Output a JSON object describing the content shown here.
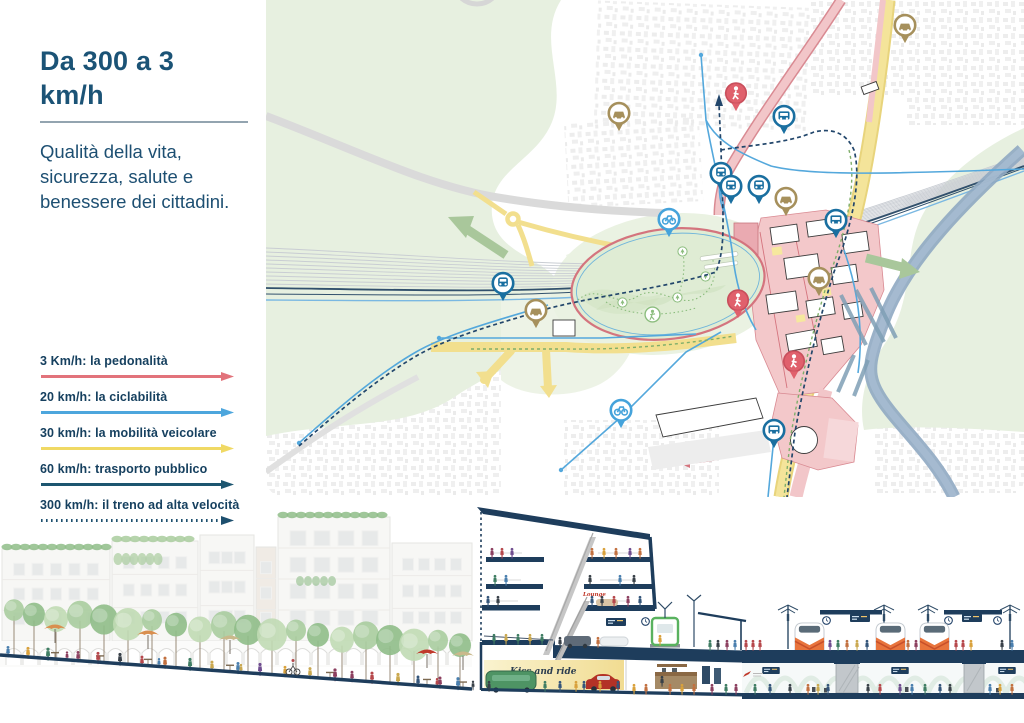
{
  "header": {
    "title_line1": "Da 300 a 3",
    "title_line2": "km/h",
    "subtitle_lines": [
      "Qualità della vita,",
      "sicurezza, salute e",
      "benessere dei cittadini."
    ]
  },
  "legend": {
    "items": [
      {
        "label": "3 Km/h: la pedonalità",
        "color": "#e2737b",
        "style": "solid"
      },
      {
        "label": "20 km/h: la ciclabilità",
        "color": "#4da6dd",
        "style": "solid"
      },
      {
        "label": "30 km/h: la mobilità veicolare",
        "color": "#f0d964",
        "style": "solid"
      },
      {
        "label": "60 km/h: trasporto pubblico",
        "color": "#1d5670",
        "style": "solid"
      },
      {
        "label": "300 km/h: il treno ad alta velocità",
        "color": "#1d4f6e",
        "style": "dotted"
      }
    ]
  },
  "section_labels": {
    "kiss_and_ride": "Kiss and ride",
    "lounge": "Lounge"
  },
  "palette": {
    "accent_navy": "#1b5376",
    "section_navy": "#1e3d5c",
    "map_green": "#e7f0e0",
    "park_green": "#dfecd4",
    "pink_route": "#f2c6c9",
    "yellow_route": "#f2df8e",
    "blue_route": "#54a8dc",
    "river_blue": "#8fa8c2"
  }
}
